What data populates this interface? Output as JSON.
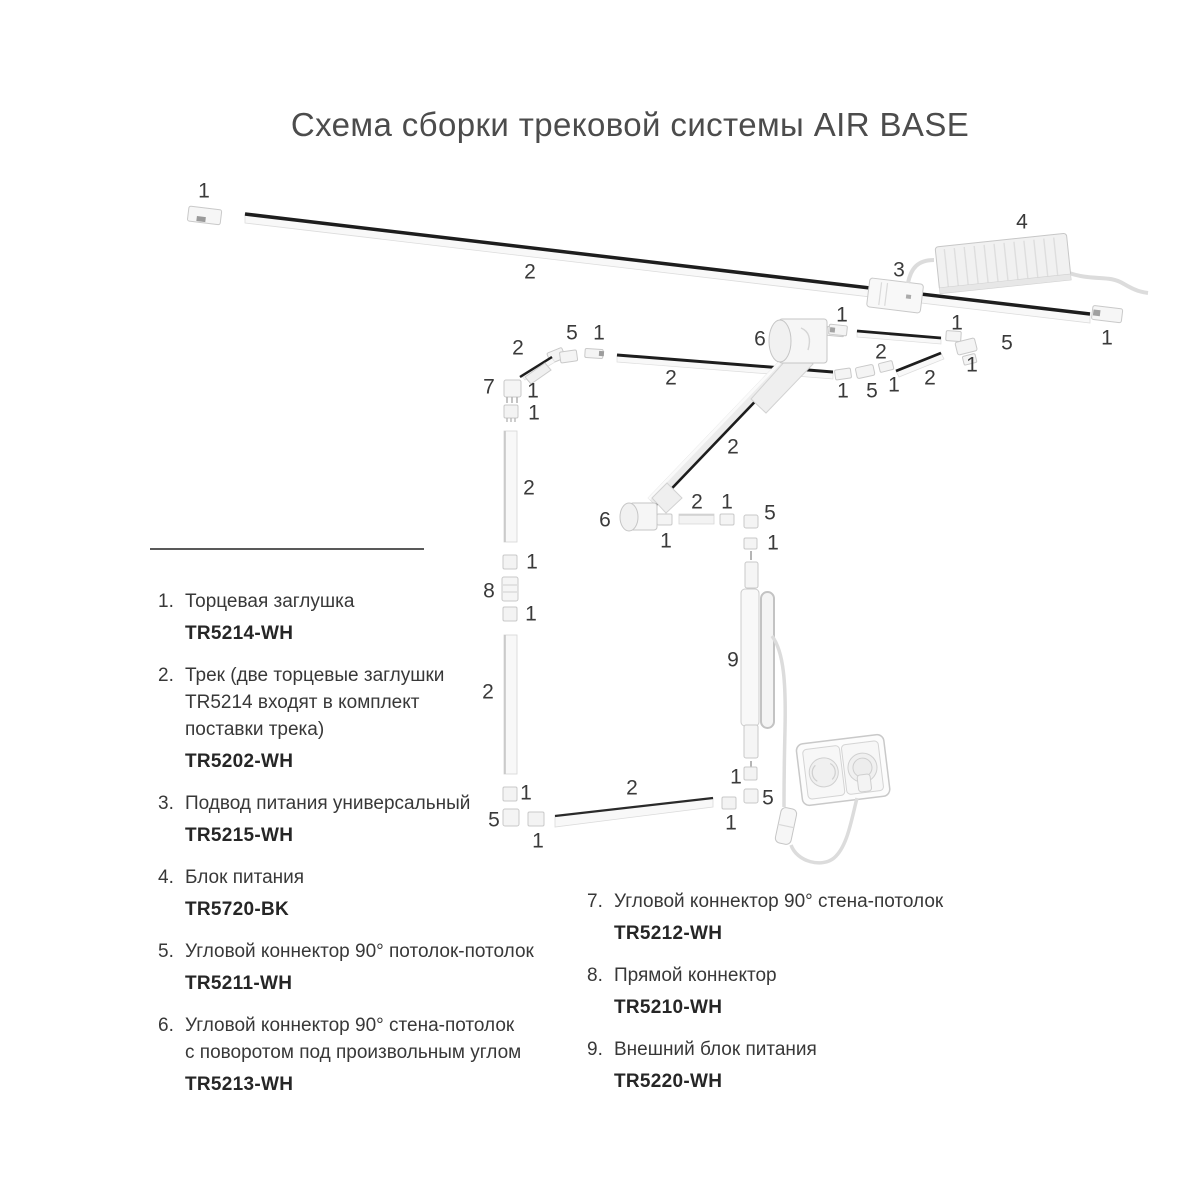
{
  "title": "Схема сборки трековой системы AIR BASE",
  "colors": {
    "title_text": "#4c4c4c",
    "legend_text": "#383838",
    "legend_code": "#262626",
    "callout_text": "#3a3a3a",
    "track_stripe": "#1d1d1d"
  },
  "diagram": {
    "callouts": [
      {
        "t": "1",
        "x": 204,
        "y": 191
      },
      {
        "t": "2",
        "x": 530,
        "y": 272
      },
      {
        "t": "3",
        "x": 899,
        "y": 270
      },
      {
        "t": "4",
        "x": 1022,
        "y": 222
      },
      {
        "t": "1",
        "x": 1107,
        "y": 338
      },
      {
        "t": "1",
        "x": 842,
        "y": 315
      },
      {
        "t": "2",
        "x": 881,
        "y": 352
      },
      {
        "t": "1",
        "x": 957,
        "y": 323
      },
      {
        "t": "5",
        "x": 1007,
        "y": 343
      },
      {
        "t": "1",
        "x": 972,
        "y": 365
      },
      {
        "t": "2",
        "x": 930,
        "y": 378
      },
      {
        "t": "1",
        "x": 843,
        "y": 391
      },
      {
        "t": "5",
        "x": 872,
        "y": 391
      },
      {
        "t": "1",
        "x": 894,
        "y": 385
      },
      {
        "t": "2",
        "x": 518,
        "y": 348
      },
      {
        "t": "5",
        "x": 572,
        "y": 333
      },
      {
        "t": "1",
        "x": 599,
        "y": 333
      },
      {
        "t": "7",
        "x": 489,
        "y": 387
      },
      {
        "t": "1",
        "x": 533,
        "y": 391
      },
      {
        "t": "1",
        "x": 534,
        "y": 413
      },
      {
        "t": "6",
        "x": 760,
        "y": 339
      },
      {
        "t": "2",
        "x": 671,
        "y": 378
      },
      {
        "t": "2",
        "x": 733,
        "y": 447
      },
      {
        "t": "6",
        "x": 605,
        "y": 520
      },
      {
        "t": "1",
        "x": 666,
        "y": 541
      },
      {
        "t": "2",
        "x": 697,
        "y": 502
      },
      {
        "t": "1",
        "x": 727,
        "y": 502
      },
      {
        "t": "5",
        "x": 770,
        "y": 513
      },
      {
        "t": "1",
        "x": 773,
        "y": 543
      },
      {
        "t": "9",
        "x": 733,
        "y": 660
      },
      {
        "t": "2",
        "x": 529,
        "y": 488
      },
      {
        "t": "1",
        "x": 532,
        "y": 562
      },
      {
        "t": "8",
        "x": 489,
        "y": 591
      },
      {
        "t": "1",
        "x": 531,
        "y": 614
      },
      {
        "t": "2",
        "x": 488,
        "y": 692
      },
      {
        "t": "1",
        "x": 526,
        "y": 793
      },
      {
        "t": "5",
        "x": 494,
        "y": 820
      },
      {
        "t": "1",
        "x": 538,
        "y": 841
      },
      {
        "t": "2",
        "x": 632,
        "y": 788
      },
      {
        "t": "1",
        "x": 736,
        "y": 777
      },
      {
        "t": "5",
        "x": 768,
        "y": 798
      },
      {
        "t": "1",
        "x": 731,
        "y": 823
      }
    ]
  },
  "legend": {
    "left_items": [
      {
        "num": "1.",
        "lines": [
          "Торцевая заглушка"
        ],
        "code": "TR5214-WH"
      },
      {
        "num": "2.",
        "lines": [
          "Трек (две торцевые заглушки",
          "TR5214 входят в комплект",
          "поставки трека)"
        ],
        "code": "TR5202-WH"
      },
      {
        "num": "3.",
        "lines": [
          "Подвод питания универсальный"
        ],
        "code": "TR5215-WH"
      },
      {
        "num": "4.",
        "lines": [
          "Блок питания"
        ],
        "code": "TR5720-BK"
      },
      {
        "num": "5.",
        "lines": [
          "Угловой коннектор 90° потолок-потолок"
        ],
        "code": "TR5211-WH"
      },
      {
        "num": "6.",
        "lines": [
          "Угловой коннектор 90° стена-потолок",
          "с поворотом под произвольным углом"
        ],
        "code": "TR5213-WH"
      }
    ],
    "right_items": [
      {
        "num": "7.",
        "lines": [
          "Угловой коннектор 90° стена-потолок"
        ],
        "code": "TR5212-WH"
      },
      {
        "num": "8.",
        "lines": [
          "Прямой коннектор"
        ],
        "code": "TR5210-WH"
      },
      {
        "num": "9.",
        "lines": [
          "Внешний блок питания"
        ],
        "code": "TR5220-WH"
      }
    ]
  }
}
